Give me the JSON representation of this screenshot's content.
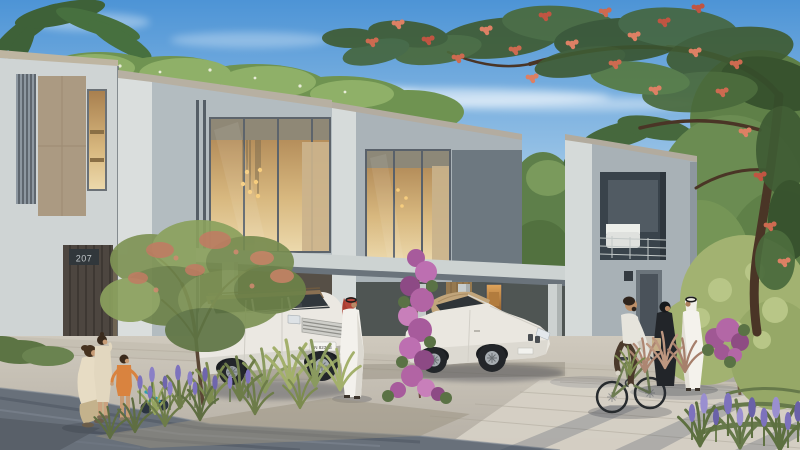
{
  "meta": {
    "type": "architectural-rendering",
    "canvas": {
      "width": 800,
      "height": 450
    }
  },
  "scene": {
    "description": "Sunlit street view of a modern townhouse community: angular grey two-storey townhouses with warm lit windows, a carport with two parked cars, residents strolling, a family with two children, a cyclist, and lush landscaping with a red-flowering flame tree and purple bougainvillea.",
    "sky": "clear blue sky with thin white clouds",
    "lighting": "bright daylight from the left"
  },
  "buildings": {
    "house_number": "207",
    "features": [
      "slatted timber screen",
      "bronze wall panel",
      "double-height lit windows",
      "pendant lights visible inside",
      "carport canopy with columns",
      "lit art niche",
      "first-floor balcony with white outdoor sofa"
    ]
  },
  "vehicles": [
    {
      "name": "white-suv",
      "description": "white luxury SUV with bronze roof parked at carport",
      "license_plate": "N 8239B"
    },
    {
      "name": "white-convertible",
      "description": "white convertible with tan soft top parked under canopy",
      "license_plate": ""
    }
  ],
  "people": [
    {
      "name": "woman-crouching",
      "description": "woman crouching beside two children on the sidewalk"
    },
    {
      "name": "child",
      "description": "child in beige outfit standing"
    },
    {
      "name": "toddler",
      "description": "toddler in orange shirt"
    },
    {
      "name": "man-kandura-red-ghutra",
      "description": "man in white kandura with red-checked ghutra standing beside the SUV"
    },
    {
      "name": "cyclist",
      "description": "bearded man in light shirt and brown trousers riding an olive-green bicycle"
    },
    {
      "name": "woman-abaya",
      "description": "woman in black abaya carrying a beige bag"
    },
    {
      "name": "man-kandura-white-ghutra",
      "description": "man in white kandura and white ghutra walking"
    }
  ],
  "flora": [
    {
      "name": "flame-tree",
      "description": "royal poinciana with red-orange blossoms overhanging from the top right"
    },
    {
      "name": "front-tree",
      "description": "young flowering tree in sidewalk planter"
    },
    {
      "name": "bougainvillea",
      "description": "magenta bougainvillea climbing a carport column"
    },
    {
      "name": "planting-bed",
      "description": "ornamental grasses and lavender in a street planting bed"
    },
    {
      "name": "foreground-lavender",
      "description": "purple lavender clump at bottom right"
    },
    {
      "name": "rooftop-shrubs",
      "description": "palms and shrubs rising above the rooflines"
    }
  ],
  "palette": {
    "sky_top": "#4d94d6",
    "sky_horizon": "#e8f1f7",
    "facade_light": "#d6dbda",
    "facade_mid": "#aab3b8",
    "facade_dark": "#6d7880",
    "fascia": "#b5aea0",
    "panel_bronze": "#ab9a82",
    "window_glow": "#d8b87f",
    "foliage_dark": "#3f5c34",
    "foliage_light": "#8fb068",
    "flame_blossom": "#cd6a50",
    "bougainvillea": "#b367a6",
    "lavender": "#7d72bd",
    "pavement": "#c9c2b6",
    "paver_band": "#68707a",
    "suv_body": "#ebe8e2",
    "suv_roof": "#8a7052",
    "convertible_top": "#c1a57b",
    "kandura_white": "#f3f1ea",
    "ghutra_red": "#b5463a"
  }
}
